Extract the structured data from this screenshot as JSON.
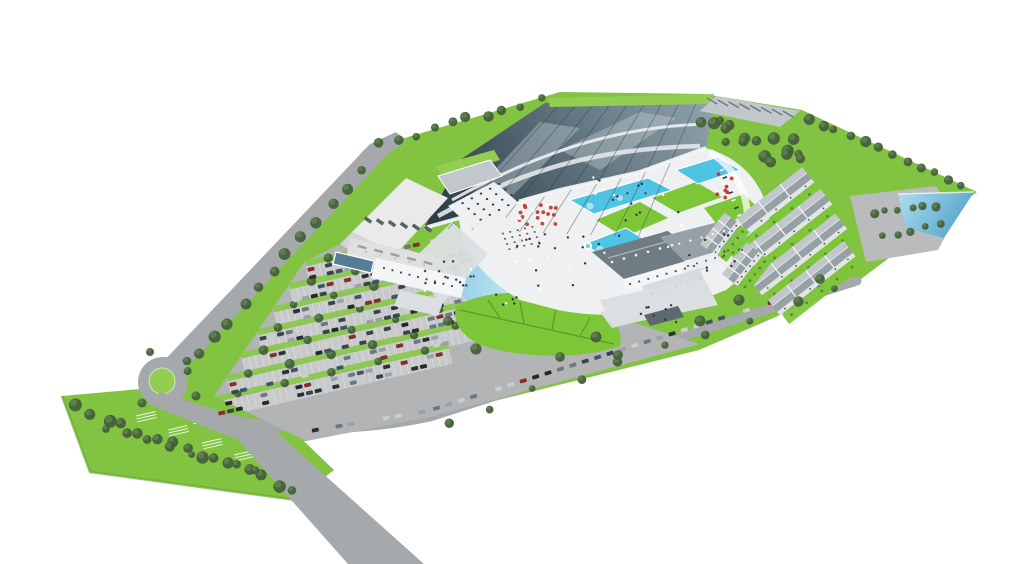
{
  "image": {
    "description": "Aerial 3D architectural rendering of a water-park resort masterplan: indoor aqua hall with glass roof, outdoor pools and lawns, hotel, rows of holiday townhouses, central pond with leaf-shaped lawn, large tree-lined surface parking, access road with roundabout, on a white background",
    "background": "#ffffff"
  },
  "palette": {
    "grassBase": "#82c341",
    "grassLight": "#93cd52",
    "lawnBright": "#7cc637",
    "treeDark": "#44603a",
    "treeMid": "#5f7f50",
    "road": "#a6a9ac",
    "roadLight": "#c6c8ca",
    "plaza": "#eef0f1",
    "pathLight": "#dcdfe1",
    "asphalt": "#b2b4b6",
    "stall": "#c8cacc",
    "poolA": "#4fc3e4",
    "poolPale": "#bfe9f4",
    "pondDeep": "#5aa9cf",
    "glassSheen": "#b8c4c9",
    "wall": "#f4f5f6",
    "wallShade": "#dfe1e0",
    "roofLight": "#c2c7cb",
    "roofMid": "#97a0a6",
    "roofDark": "#707c84",
    "umbrellaRed": "#c23b2e",
    "personDark": "#2f3337"
  },
  "scene": {
    "regions": [
      "indoor-aqua-hall",
      "outdoor-pools",
      "sunbathing-lawns",
      "hotel",
      "holiday-townhouses",
      "central-pond",
      "leaf-lawn",
      "surface-parking",
      "access-road",
      "roundabout",
      "overflow-meadow",
      "tip-pond",
      "tree-belts"
    ],
    "treeLines": [
      [
        378,
        144,
        540,
        100,
        10,
        4.5,
        3
      ],
      [
        808,
        118,
        962,
        186,
        12,
        4.5,
        3
      ],
      [
        360,
        172,
        186,
        372,
        13,
        5,
        3
      ],
      [
        76,
        408,
        294,
        489,
        15,
        5,
        4
      ],
      [
        104,
        430,
        258,
        468,
        8,
        4,
        3
      ],
      [
        450,
        420,
        838,
        291,
        10,
        4,
        5
      ],
      [
        874,
        214,
        936,
        205,
        6,
        4,
        2
      ],
      [
        882,
        237,
        942,
        225,
        5,
        3.5,
        2
      ],
      [
        700,
        116,
        806,
        152,
        9,
        5,
        9
      ],
      [
        706,
        132,
        800,
        166,
        8,
        5,
        9
      ]
    ],
    "treeExtras": [
      [
        150,
        352
      ],
      [
        187,
        361
      ],
      [
        196,
        396
      ],
      [
        142,
        403
      ],
      [
        448,
        321
      ],
      [
        476,
        349
      ],
      [
        560,
        357
      ],
      [
        618,
        355
      ],
      [
        700,
        321
      ],
      [
        596,
        337
      ],
      [
        739,
        300
      ],
      [
        820,
        279
      ]
    ],
    "parkingRows": [
      [
        308,
        274,
        140
      ],
      [
        292,
        297,
        225
      ],
      [
        276,
        320,
        330
      ],
      [
        260,
        343,
        420
      ],
      [
        244,
        366,
        452
      ],
      [
        230,
        389,
        468
      ],
      [
        217,
        410,
        240
      ]
    ],
    "carLines": [
      {
        "x1": 438,
        "y1": 413,
        "x2": 846,
        "y2": 284,
        "step": 13,
        "prob": 0.8,
        "angle": -17,
        "off": -5
      },
      {
        "x1": 316,
        "y1": 434,
        "x2": 428,
        "y2": 415,
        "step": 12,
        "prob": 0.6,
        "angle": -13,
        "off": -4
      },
      {
        "x1": 720,
        "y1": 102,
        "x2": 794,
        "y2": 113,
        "step": 10,
        "prob": 0.85,
        "angle": 8,
        "off": 0
      }
    ],
    "carColors": [
      "#24282b",
      "#3c4348",
      "#6e7880",
      "#c9ced1",
      "#9aa2a8",
      "#41546b",
      "#2b3034",
      "#852d28"
    ],
    "peopleClusters": [
      {
        "cx": 555,
        "cy": 258,
        "rx": 50,
        "ry": 34,
        "n": 24
      },
      {
        "cx": 640,
        "cy": 215,
        "rx": 46,
        "ry": 26,
        "n": 12
      },
      {
        "cx": 715,
        "cy": 252,
        "rx": 28,
        "ry": 22,
        "n": 10
      },
      {
        "cx": 462,
        "cy": 268,
        "rx": 22,
        "ry": 18,
        "n": 10
      },
      {
        "cx": 508,
        "cy": 298,
        "rx": 18,
        "ry": 10,
        "n": 6
      },
      {
        "cx": 660,
        "cy": 314,
        "rx": 28,
        "ry": 10,
        "n": 8
      },
      {
        "cx": 610,
        "cy": 190,
        "rx": 40,
        "ry": 14,
        "n": 8
      },
      {
        "cx": 430,
        "cy": 280,
        "rx": 16,
        "ry": 14,
        "n": 6
      }
    ],
    "umbrellaClusters": [
      {
        "cx": 538,
        "cy": 215,
        "rx": 24,
        "ry": 15,
        "n": 22
      },
      {
        "cx": 724,
        "cy": 186,
        "rx": 9,
        "ry": 16,
        "n": 8
      }
    ],
    "loungers": {
      "x1": 722,
      "y1": 170,
      "x2": 748,
      "y2": 238,
      "n": 10
    },
    "tableGrids": [
      {
        "ox": 455,
        "oy": 203,
        "ux": 9.2,
        "uy": -4.8,
        "vx": 6,
        "vy": 5.5,
        "cols": 5,
        "rows": 4,
        "s": 2.2,
        "color": "#2e3338"
      },
      {
        "ox": 498,
        "oy": 232,
        "ux": 7.4,
        "uy": -1.7,
        "vx": 2.2,
        "vy": 5.2,
        "cols": 5,
        "rows": 4,
        "s": 2,
        "color": "#555c61"
      }
    ],
    "overflowMarks": [
      [
        136,
        416
      ],
      [
        168,
        430
      ],
      [
        202,
        443
      ],
      [
        234,
        455
      ],
      [
        264,
        465
      ],
      [
        192,
        418
      ]
    ],
    "fountains": [
      [
        612,
        252,
        5
      ],
      [
        636,
        260,
        5
      ],
      [
        588,
        246,
        4
      ]
    ],
    "spaPools": [
      [
        652,
        278,
        6
      ],
      [
        670,
        272,
        5
      ],
      [
        686,
        282,
        4.5
      ],
      [
        662,
        290,
        4
      ]
    ],
    "poolInsets": [
      [
        600,
        250,
        4
      ],
      [
        694,
        252,
        6
      ],
      [
        710,
        258,
        4.5
      ],
      [
        590,
        206,
        3.5
      ],
      [
        620,
        198,
        3
      ]
    ],
    "dotLines": [
      {
        "x1": 384,
        "y1": 268,
        "x2": 452,
        "y2": 286,
        "n": 9,
        "r": 1.1,
        "c": "#454b50"
      },
      {
        "x1": 630,
        "y1": 284,
        "x2": 694,
        "y2": 266,
        "n": 8,
        "r": 1.1,
        "c": "#4a5157"
      },
      {
        "x1": 688,
        "y1": 266,
        "x2": 742,
        "y2": 250,
        "n": 7,
        "r": 1,
        "c": "#4a5157"
      },
      {
        "x1": 652,
        "y1": 294,
        "x2": 700,
        "y2": 278,
        "n": 5,
        "r": 1.3,
        "c": "#e0d3a0"
      },
      {
        "x1": 612,
        "y1": 262,
        "x2": 672,
        "y2": 245,
        "n": 6,
        "r": 1.3,
        "c": "#f5f6f7"
      },
      {
        "x1": 668,
        "y1": 247,
        "x2": 724,
        "y2": 231,
        "n": 6,
        "r": 1.2,
        "c": "#f2f3f4"
      },
      {
        "x1": 366,
        "y1": 252,
        "x2": 424,
        "y2": 265,
        "n": 5,
        "r": 1.2,
        "c": "#d9c79a"
      }
    ],
    "tickLines": [
      {
        "x1": 368,
        "y1": 220,
        "x2": 428,
        "y2": 229,
        "n": 6,
        "w": 3.5,
        "h": 8,
        "a": -55,
        "c": "#5a6166"
      },
      {
        "x1": 362,
        "y1": 247,
        "x2": 428,
        "y2": 263,
        "n": 5,
        "w": 2.5,
        "h": 9,
        "a": -75,
        "c": "#99a2a7"
      },
      {
        "x1": 712,
        "y1": 101,
        "x2": 788,
        "y2": 114,
        "n": 8,
        "w": 1.5,
        "h": 12,
        "a": -60,
        "c": "#6e7a82"
      }
    ],
    "townhouseRows": [
      {
        "x": 714,
        "y": 236,
        "len": 112
      },
      {
        "x": 732,
        "y": 258,
        "len": 112
      },
      {
        "x": 750,
        "y": 280,
        "len": 108
      },
      {
        "x": 768,
        "y": 300,
        "len": 96
      }
    ],
    "townhouseArcBlocks": [
      {
        "x": 700,
        "y": 244,
        "len": 40
      },
      {
        "x": 722,
        "y": 274,
        "len": 40
      }
    ],
    "hallMullions": 9
  }
}
